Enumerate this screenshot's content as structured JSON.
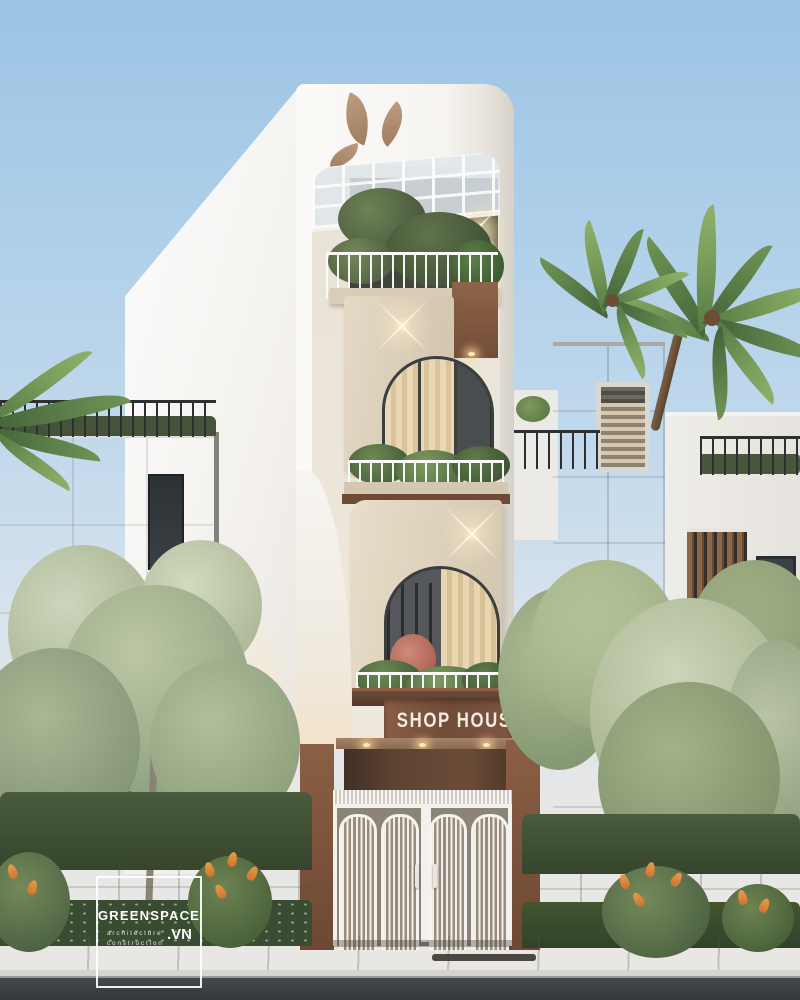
{
  "scene": {
    "type": "architectural-exterior-render",
    "subject": "narrow modern shop house facade at dusk"
  },
  "signage": {
    "shop_sign": "SHOP HOUSE"
  },
  "watermark": {
    "brand": "GREENSPACE",
    "tagline_line1": "architecture",
    "tagline_line2": "construction",
    "domain_suffix": ".VN"
  },
  "logo": {
    "name": "leaf-cutout-logo",
    "leaf_count": 3
  },
  "palette": {
    "sky_top": "#9cc3e4",
    "sky_horizon": "#e6e7e6",
    "facade_white": "#f7f5f2",
    "facade_cream": "#d9ccb7",
    "copper_brown": "#84593f",
    "sign_panel_brown": "#7c5440",
    "sign_text_white": "#f2ece2",
    "foliage_dark": "#3c4f33",
    "foliage_light": "#c3cdb2",
    "road_asphalt": "#3b3e41",
    "sidewalk_concrete": "#bcbbb6"
  }
}
